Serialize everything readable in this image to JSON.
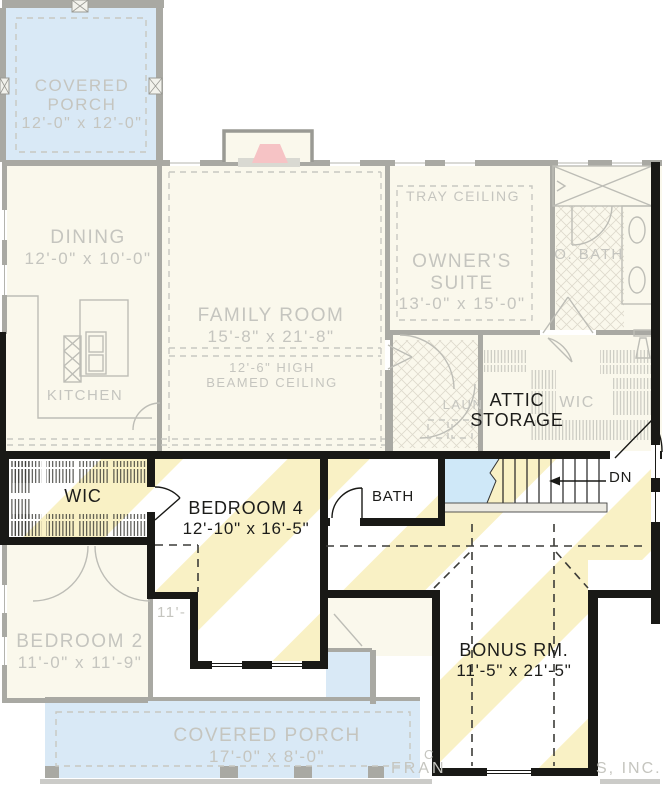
{
  "ghost": {
    "covered_porch_top": {
      "name": "COVERED\nPORCH",
      "dims": "12'-0\" x 12'-0\""
    },
    "dining": {
      "name": "DINING",
      "dims": "12'-0\" x 10'-0\""
    },
    "family_room": {
      "name": "FAMILY ROOM",
      "dims": "15'-8\" x 21'-8\"",
      "ceiling_note": "12'-6\" HIGH\nBEAMED CEILING"
    },
    "tray_ceiling_label": "TRAY CEILING",
    "owners_suite": {
      "name": "OWNER'S\nSUITE",
      "dims": "13'-0\" x 15'-0\""
    },
    "owners_bath_label": "O. BATH",
    "kitchen_label": "KITCHEN",
    "laundry_label": "LAUN",
    "wic_label": "WIC",
    "bedroom2": {
      "name": "BEDROOM 2",
      "dims": "11'-0\" x 11'-9\""
    },
    "covered_porch_bottom": {
      "name": "COVERED PORCH",
      "dims": "17'-0\" x 8'-0\""
    },
    "hidden_room_dims_fragment": "11'-"
  },
  "second_floor": {
    "attic_storage_label": "ATTIC\nSTORAGE",
    "wic_label": "WIC",
    "bedroom4": {
      "name": "BEDROOM 4",
      "dims": "12'-10\" x 16'-5\""
    },
    "bath_label": "BATH",
    "stairs_down_label": "DN",
    "bonus_room": {
      "name": "BONUS RM.",
      "dims": "11'-5\" x 21'-5\""
    }
  },
  "watermark": {
    "fragment_1": "C",
    "fragment_2": "FRAN",
    "fragment_3": "S, INC."
  },
  "colors": {
    "floor_cream": "#faf8ec",
    "porch_blue": "#d9e9f6",
    "stair_blue": "#cfe8f8",
    "stripe_yellow": "#f9f1c5",
    "ghost_line": "#b9b9b2",
    "ghost_wall": "#a9a9a3",
    "ghost_text": "#c5c5bf",
    "wall_black": "#191916",
    "dark_text": "#1c1c1a",
    "firebox_pink": "#f6c3c5"
  }
}
